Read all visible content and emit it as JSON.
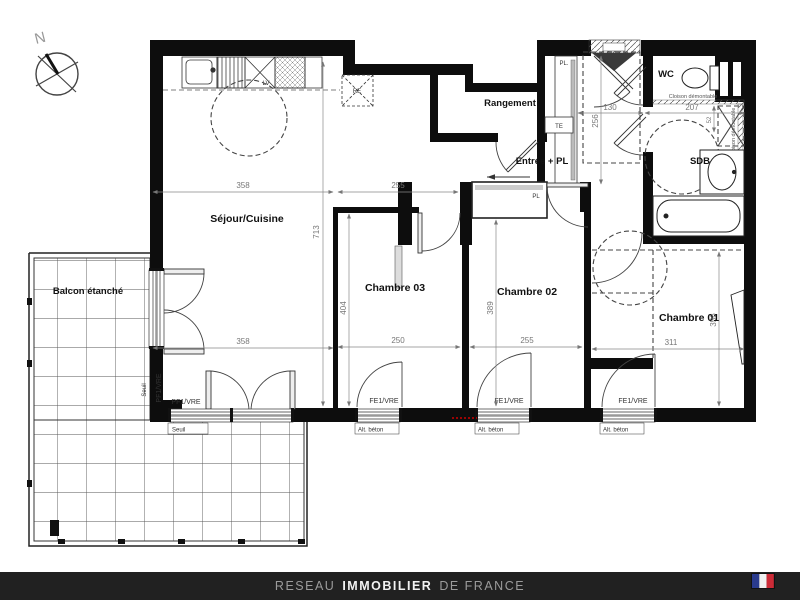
{
  "compass": {
    "north": "N"
  },
  "rooms": {
    "sejour": "Séjour/Cuisine",
    "rangement": "Rangement",
    "entree": "Entrée + PL",
    "wc": "WC",
    "sdb": "SDB",
    "chambre03": "Chambre 03",
    "chambre02": "Chambre 02",
    "chambre01": "Chambre 01",
    "balcon": "Balcon étanché"
  },
  "fixtures": {
    "lv": "LV",
    "re": "RE",
    "te": "TE",
    "pl_entree": "PL.",
    "pl_chambre02": "PL",
    "cloison": "Cloison démontable"
  },
  "dimensions": {
    "sejour_w_top": "358",
    "sejour_w_bottom": "358",
    "sejour_h": "713",
    "c3_w_top": "255",
    "c3_w_bottom": "250",
    "c3_h": "404",
    "c2_w_bottom": "255",
    "c2_h": "389",
    "c1_w": "311",
    "c1_h": "356",
    "hall_w": "130",
    "hall_h": "256",
    "wc_w": "207",
    "gaine_w": "52"
  },
  "windows": {
    "pf": "PF1/VRE",
    "fe": "FE1/VRE",
    "seuil": "Seuil",
    "alt_beton": "Alt. béton"
  },
  "footer": {
    "part1": "RESEAU",
    "part2": "IMMOBILIER",
    "part3": "DE FRANCE"
  },
  "colors": {
    "wall": "#0d0d0d",
    "banner_bg": "#212121",
    "banner_gray": "#9b9b9b",
    "banner_white": "#f2f2f2",
    "flag_blue": "#2a3b8e",
    "flag_white": "#f0f0f0",
    "flag_red": "#cc2b37",
    "accent_red": "#cc0000"
  }
}
